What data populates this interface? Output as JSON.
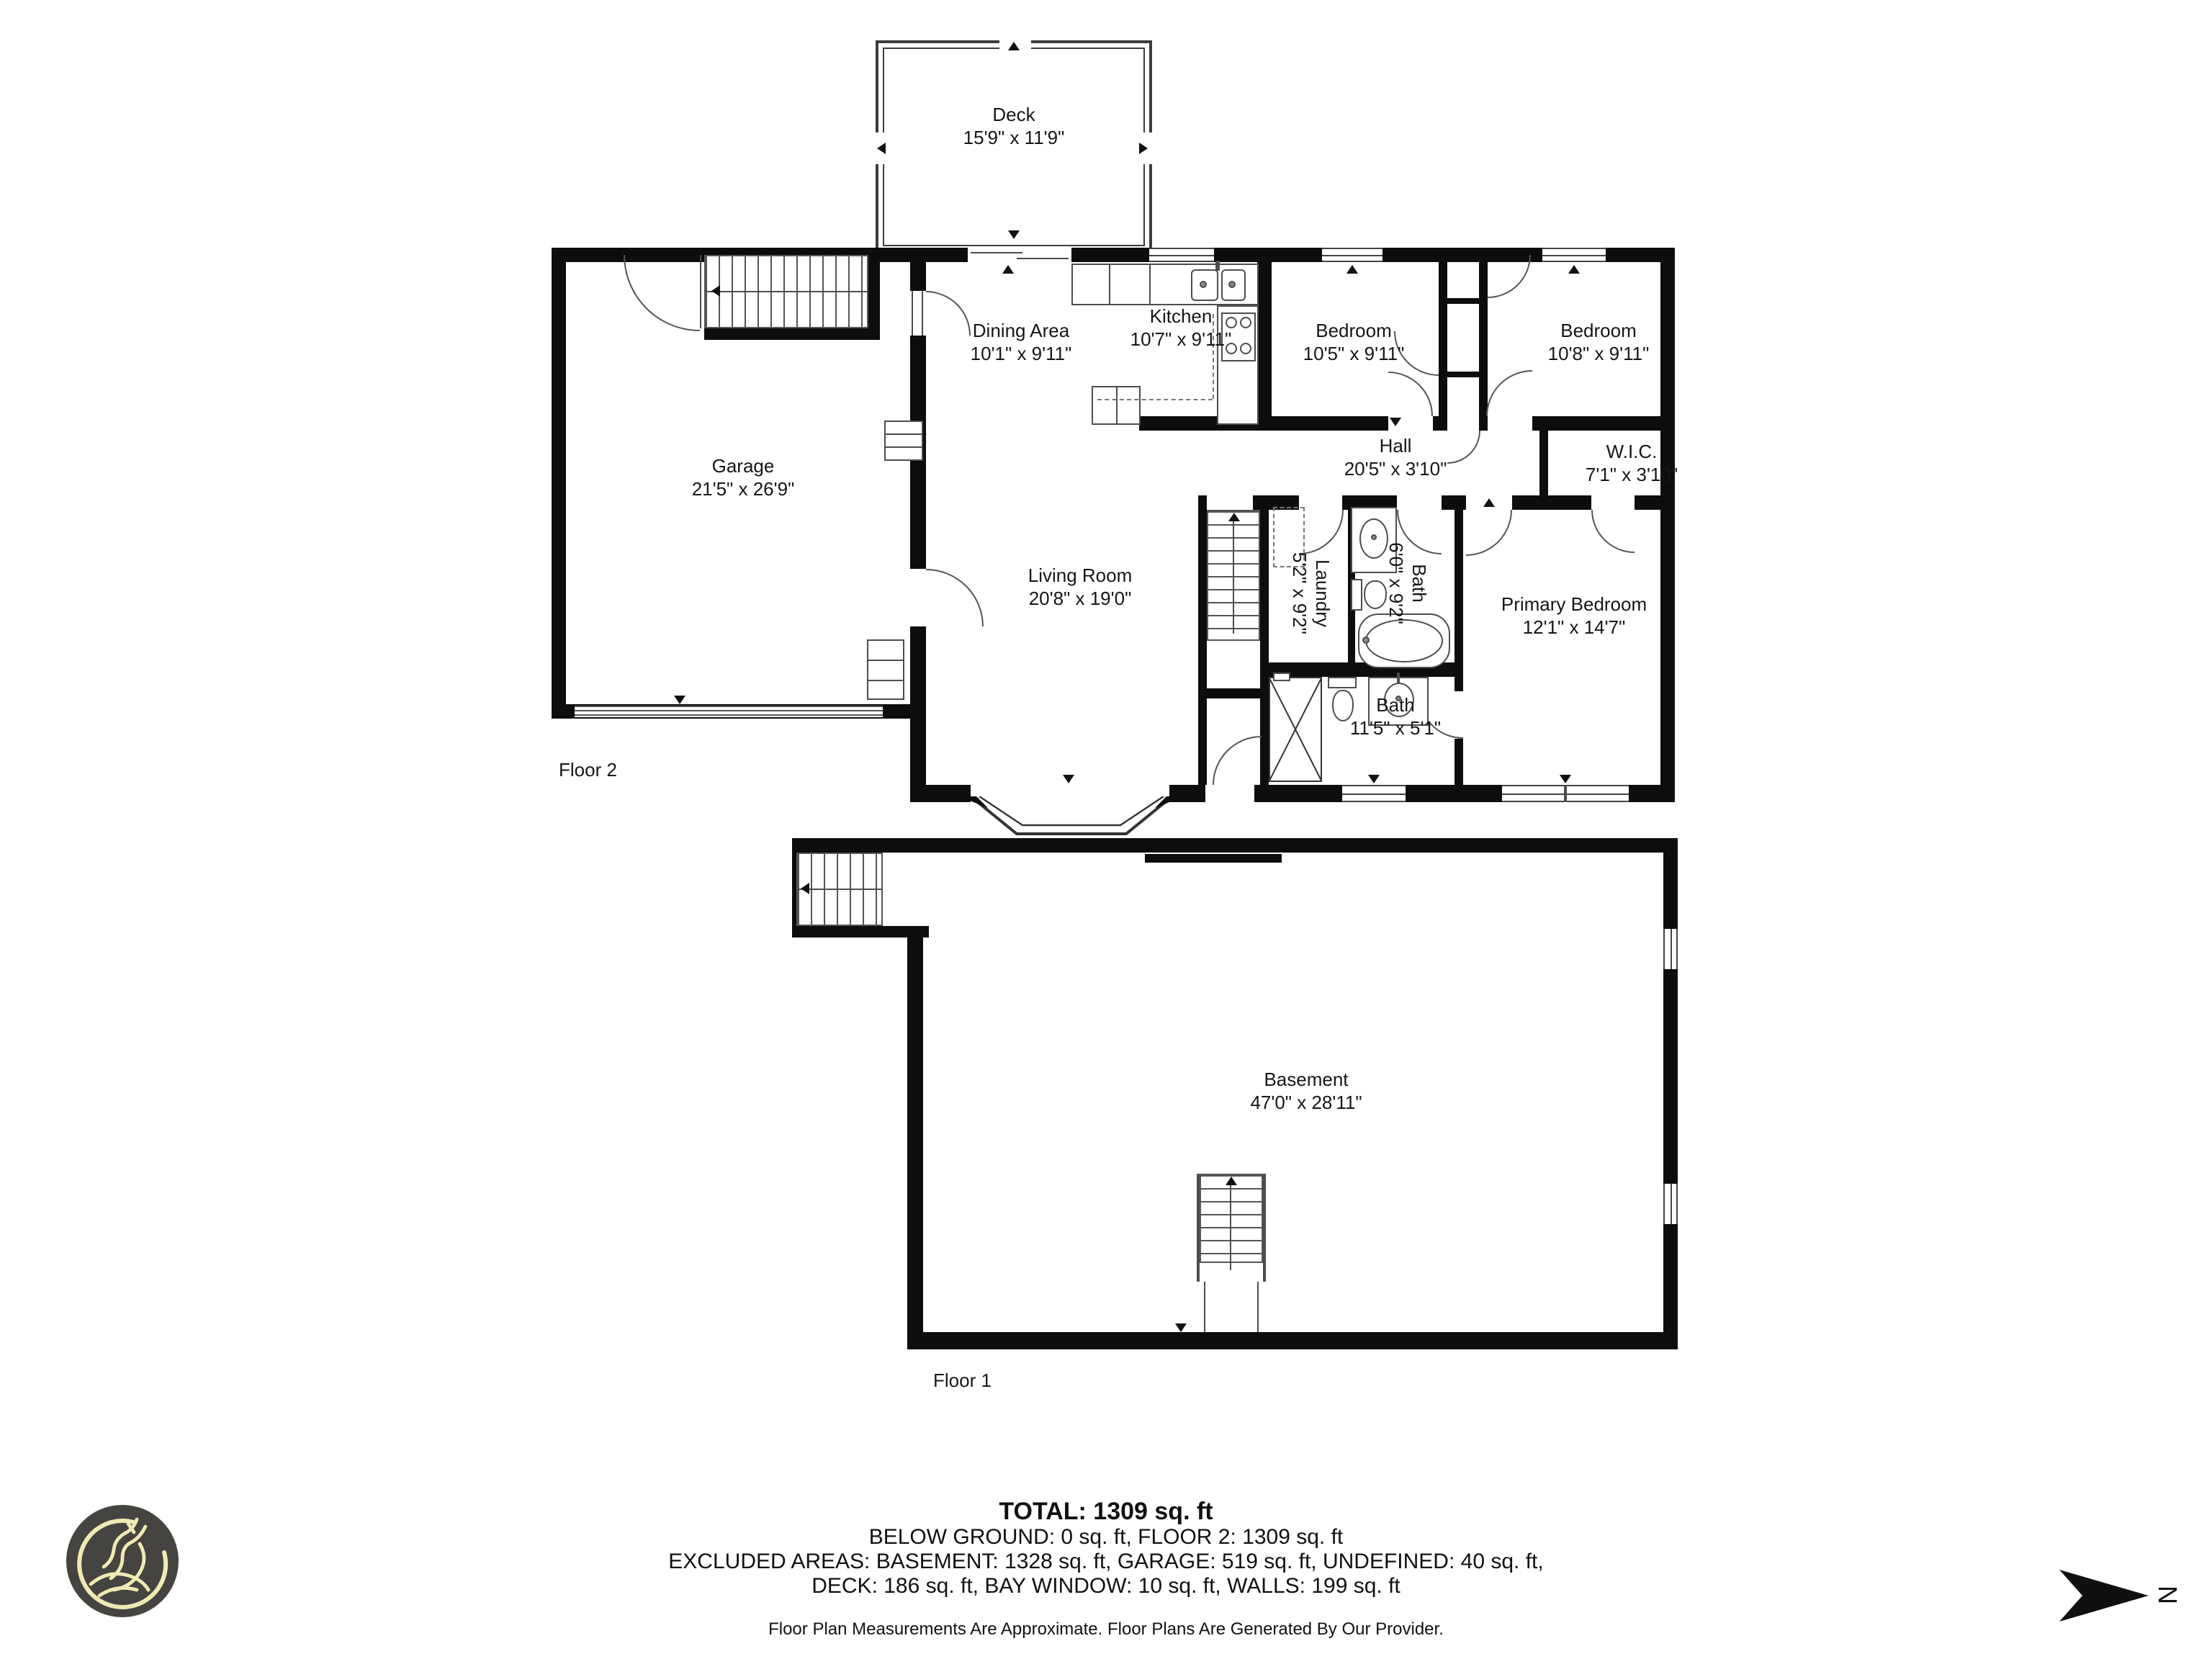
{
  "rooms": {
    "deck": {
      "name": "Deck",
      "dims": "15'9\" x 11'9\""
    },
    "garage": {
      "name": "Garage",
      "dims": "21'5\" x 26'9\""
    },
    "dining": {
      "name": "Dining Area",
      "dims": "10'1\" x 9'11\""
    },
    "kitchen": {
      "name": "Kitchen",
      "dims": "10'7\" x 9'11\""
    },
    "bedroom1": {
      "name": "Bedroom",
      "dims": "10'5\" x 9'11\""
    },
    "bedroom2": {
      "name": "Bedroom",
      "dims": "10'8\" x 9'11\""
    },
    "hall": {
      "name": "Hall",
      "dims": "20'5\" x 3'10\""
    },
    "wic": {
      "name": "W.I.C.",
      "dims": "7'1\" x 3'10\""
    },
    "living": {
      "name": "Living Room",
      "dims": "20'8\" x 19'0\""
    },
    "laundry": {
      "name": "Laundry",
      "dims": "5'2\" x 9'2\""
    },
    "bath_upper": {
      "name": "Bath",
      "dims": "6'0\" x 9'2\""
    },
    "primary": {
      "name": "Primary Bedroom",
      "dims": "12'1\" x 14'7\""
    },
    "bath_lower": {
      "name": "Bath",
      "dims": "11'5\" x 5'1\""
    },
    "basement": {
      "name": "Basement",
      "dims": "47'0\" x 28'11\""
    }
  },
  "floor_labels": {
    "floor2": "Floor 2",
    "floor1": "Floor 1"
  },
  "summary": {
    "total": "TOTAL: 1309 sq. ft",
    "line1": "BELOW GROUND: 0 sq. ft, FLOOR 2: 1309 sq. ft",
    "line2": "EXCLUDED AREAS: BASEMENT: 1328 sq. ft, GARAGE: 519 sq. ft, UNDEFINED: 40 sq. ft,",
    "line3": "DECK: 186 sq. ft, BAY WINDOW: 10 sq. ft, WALLS: 199 sq. ft",
    "disclaimer": "Floor Plan Measurements Are Approximate. Floor Plans Are Generated By Our Provider."
  },
  "compass": {
    "north": "N"
  },
  "colors": {
    "wall": "#0d0d0d",
    "line": "#4d4d4d",
    "logo_bg": "#454440",
    "logo_line": "#f0e9b4"
  }
}
